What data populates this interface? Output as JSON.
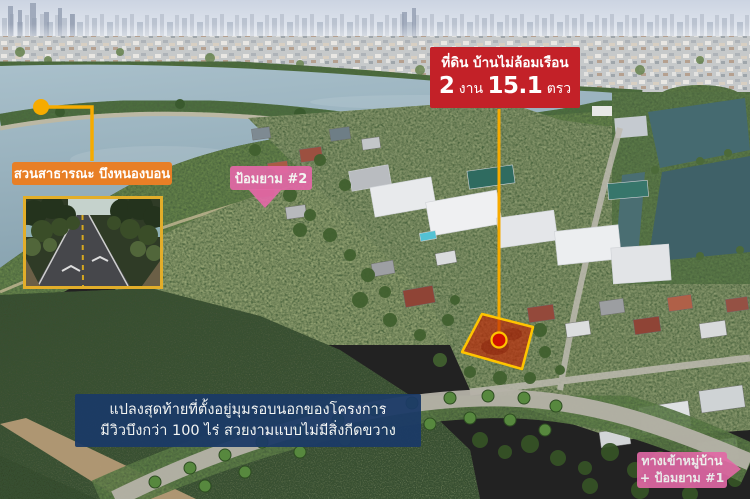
{
  "colors": {
    "red": "#c32128",
    "orange": "#e87f26",
    "pink": "#e268a6",
    "navy": "#1b3a67",
    "gold": "#e2ae2a",
    "yellow": "#f6ab00",
    "plot_fill": "#bf2604"
  },
  "labels": {
    "plot": {
      "title": "ที่ดิน บ้านไม่ล้อมเรือน",
      "size_n1": "2",
      "size_u1": " งาน ",
      "size_n2": "15.1",
      "size_u2": " ตรว"
    },
    "park": {
      "text": "สวนสาธารณะ บึงหนองบอน"
    },
    "guard2": {
      "text": "ป้อมยาม #2"
    },
    "info": {
      "line1": "แปลงสุดท้ายที่ตั้งอยู่มุมรอบนอกของโครงการ",
      "line2": "มีวิวบึงกว่า 100 ไร่ สวยงามแบบไม่มีสิ่งกีดขวาง"
    },
    "entrance": {
      "line1": "ทางเข้าหมู่บ้าน",
      "line2": "+ ป้อมยาม #1"
    }
  }
}
